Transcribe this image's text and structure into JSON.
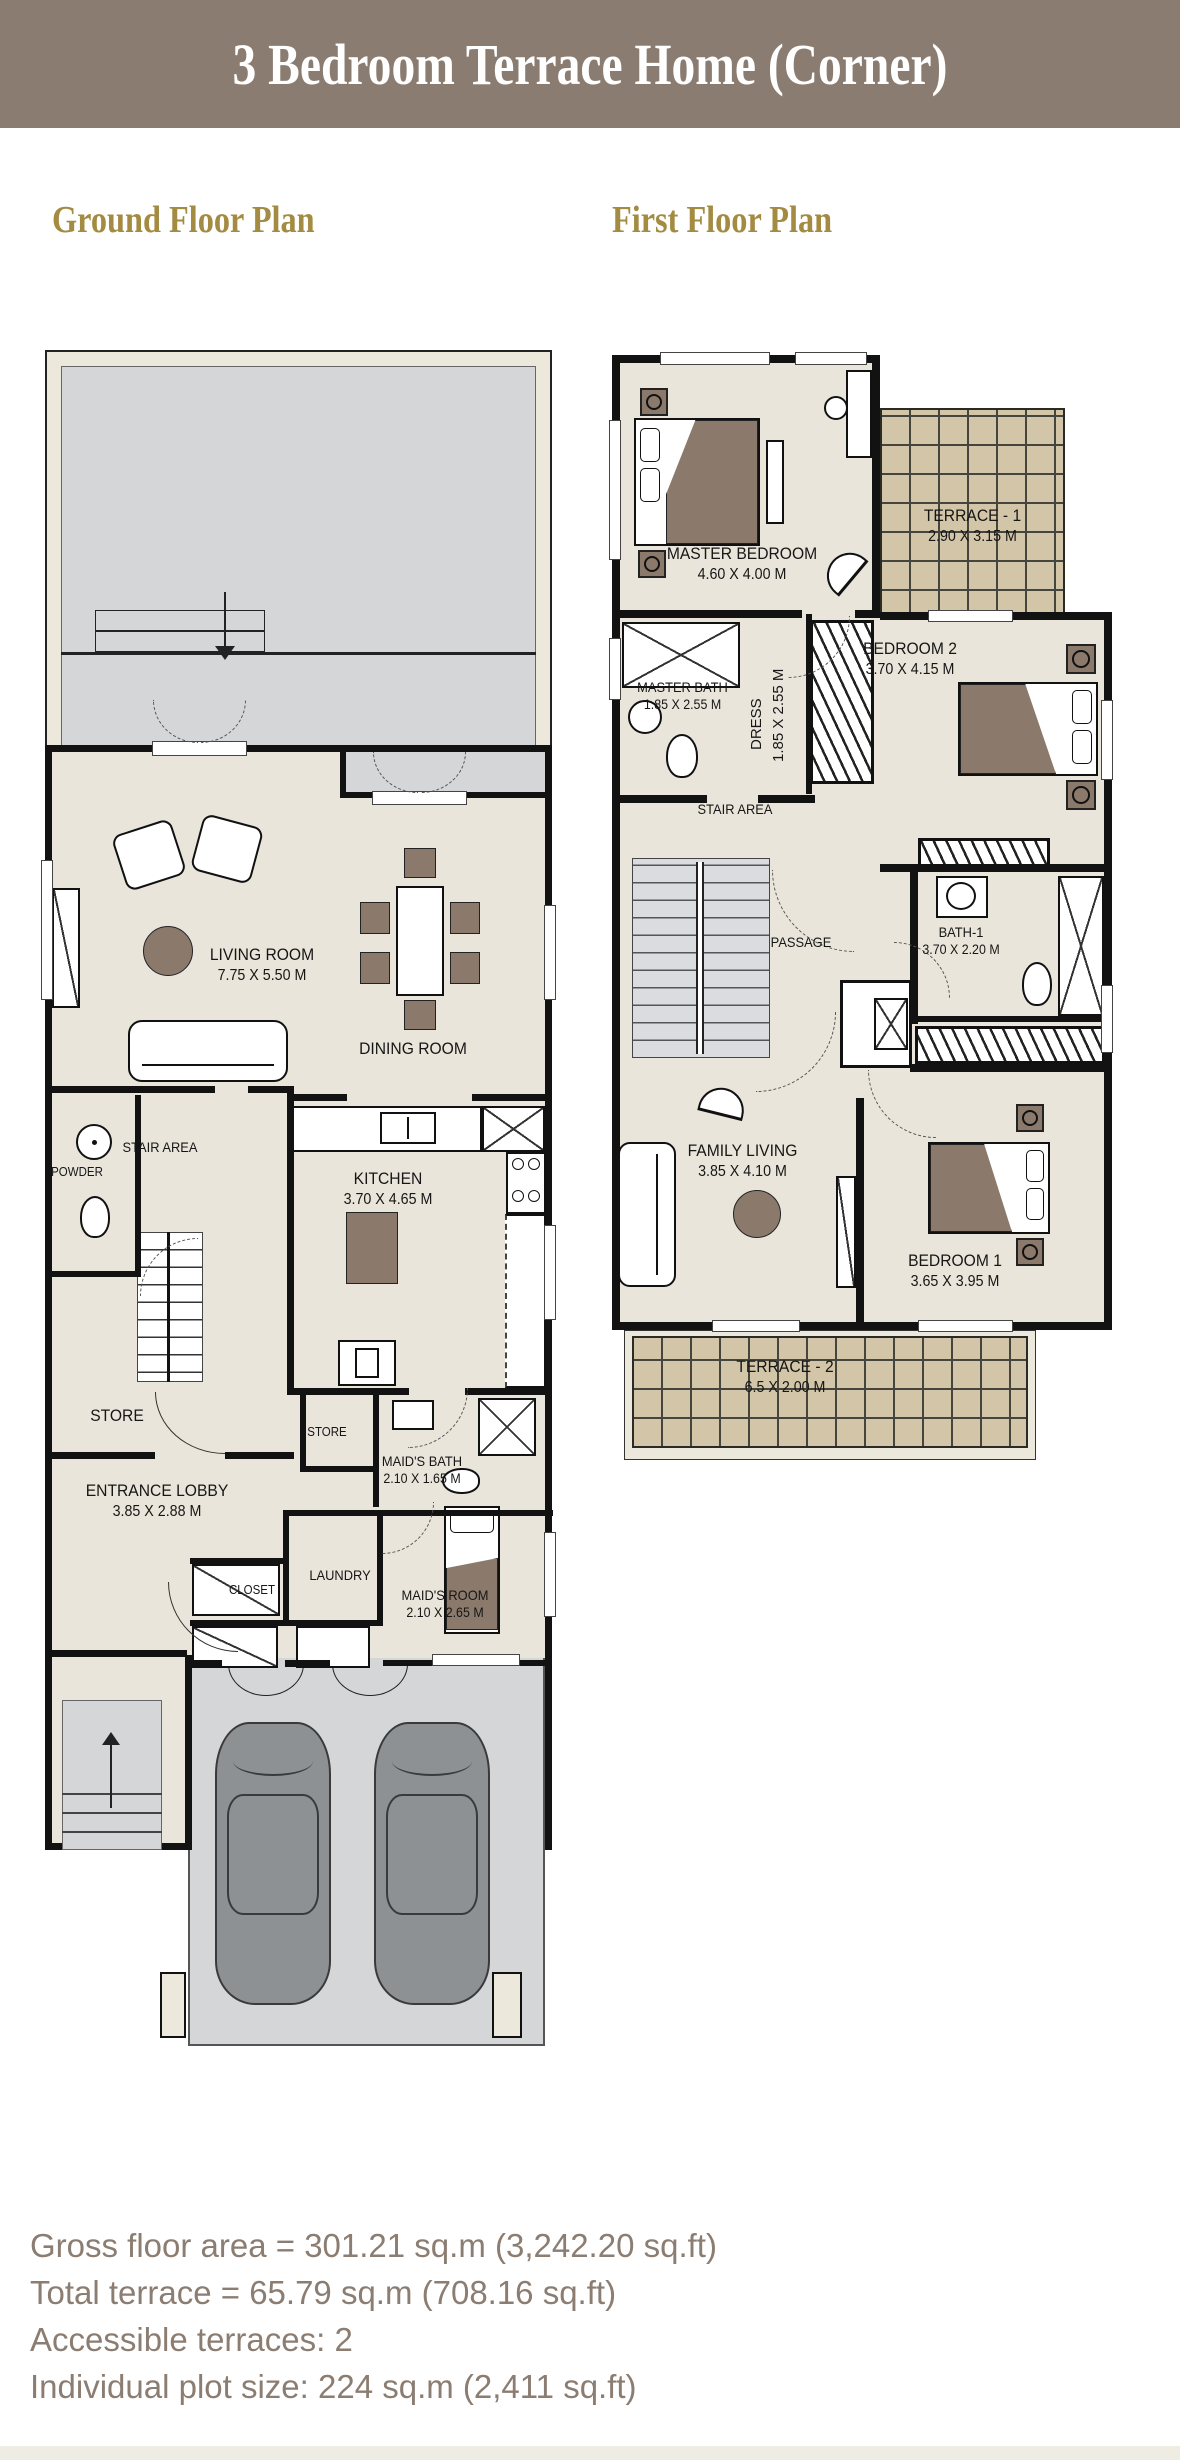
{
  "title": "3 Bedroom Terrace Home (Corner)",
  "sections": {
    "ground": "Ground Floor Plan",
    "first": "First Floor Plan"
  },
  "ground": {
    "living": {
      "name": "LIVING ROOM",
      "dims": "7.75 X 5.50 M"
    },
    "dining": {
      "name": "DINING ROOM"
    },
    "kitchen": {
      "name": "KITCHEN",
      "dims": "3.70 X 4.65 M"
    },
    "stair_area": {
      "name": "STAIR AREA"
    },
    "powder": {
      "name": "POWDER"
    },
    "store_main": {
      "name": "STORE"
    },
    "store_small": {
      "name": "STORE"
    },
    "entrance_lobby": {
      "name": "ENTRANCE LOBBY",
      "dims": "3.85 X 2.88 M"
    },
    "maids_bath": {
      "name": "MAID'S BATH",
      "dims": "2.10 X 1.65 M"
    },
    "laundry": {
      "name": "LAUNDRY"
    },
    "closet": {
      "name": "CLOSET"
    },
    "maids_room": {
      "name": "MAID'S ROOM",
      "dims": "2.10 X 2.65 M"
    }
  },
  "first": {
    "master_bedroom": {
      "name": "MASTER BEDROOM",
      "dims": "4.60 X 4.00 M"
    },
    "terrace_1": {
      "name": "TERRACE - 1",
      "dims": "2.90 X 3.15 M"
    },
    "master_bath": {
      "name": "MASTER BATH",
      "dims": "1.85 X 2.55 M"
    },
    "dress": {
      "name": "DRESS",
      "dims": "1.85 X 2.55 M"
    },
    "bedroom_2": {
      "name": "BEDROOM 2",
      "dims": "3.70 X 4.15 M"
    },
    "stair_area": {
      "name": "STAIR AREA"
    },
    "passage": {
      "name": "PASSAGE"
    },
    "bath_1": {
      "name": "BATH-1",
      "dims": "3.70 X 2.20 M"
    },
    "family_living": {
      "name": "FAMILY LIVING",
      "dims": "3.85 X 4.10 M"
    },
    "bedroom_1": {
      "name": "BEDROOM 1",
      "dims": "3.65 X 3.95 M"
    },
    "terrace_2": {
      "name": "TERRACE - 2",
      "dims": "6.5 X 2.00 M"
    }
  },
  "footer": {
    "lines": [
      "Gross floor area = 301.21 sq.m (3,242.20 sq.ft)",
      "Total terrace = 65.79 sq.m (708.16 sq.ft)",
      "Accessible terraces: 2",
      "Individual plot size: 224 sq.m (2,411 sq.ft)"
    ]
  },
  "colors": {
    "title_bar": "#8a7c70",
    "heading_gold": "#a38b42",
    "floor_beige": "#e9e5da",
    "yard_gray": "#d4d6d8",
    "terrace_tan": "#d3c6a8",
    "wall_black": "#121212",
    "furniture_brown": "#8b7a6c",
    "car_gray": "#8e9194",
    "footer_text": "#8b7d71"
  }
}
